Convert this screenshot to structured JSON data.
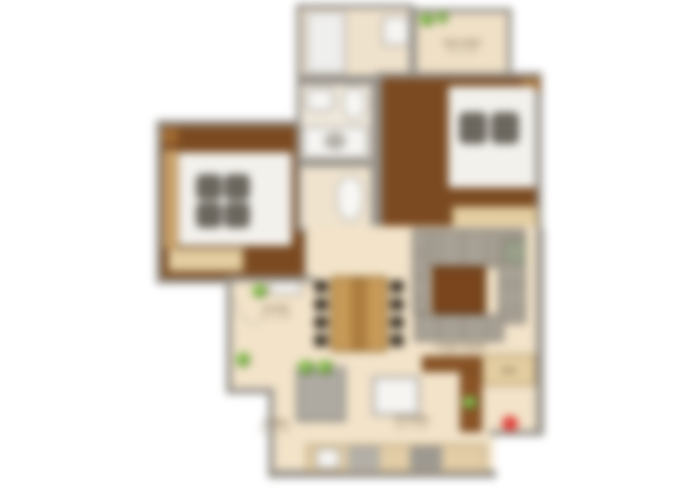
{
  "image": {
    "kind": "blurred residential floor plan, 2 bedroom apartment, top-down render",
    "background_color": "#ffffff"
  },
  "palette": {
    "wall_gray": "#96918a",
    "bedroom_wood_floor": "#7b4a21",
    "living_tile_floor": "#f2e3c9",
    "bath_floor": "#f0e9dc",
    "wardrobe_beige": "#e9d4a8",
    "dining_wood": "#c79a58",
    "coffee_table_wood": "#7a451d",
    "sofa_gray": "#a7a094",
    "plant_green": "#4e7a2a",
    "watermark_red": "#e0433c"
  },
  "labels": {
    "balcony": {
      "name": "BALCONY",
      "dims": "7'6\" X 4'0\""
    },
    "foyer": {
      "name": "FOYER",
      "dims": "5'6\" X 4'6\""
    },
    "living": {
      "name": "LIVING ROOM",
      "dims": "13'6\" X 10'0\""
    },
    "kitchen": {
      "name": "KITCHEN",
      "dims": "10'0\" X 8'0\""
    },
    "passage": {
      "name": "STORE",
      "dims": "5'0\" X 4'0\""
    },
    "fridge": {
      "name": "REF."
    }
  },
  "rooms": [
    "utility-shower-room",
    "balcony",
    "bedroom-right",
    "bedroom-left",
    "bathroom-top",
    "toilet-bottom",
    "foyer",
    "living-dining",
    "kitchen"
  ],
  "furniture": {
    "beds": 2,
    "wardrobes": 2,
    "dining_chairs": 8,
    "dining_table": 1,
    "l_shaped_sofa": 1,
    "coffee_table": 1,
    "tv_console": 1,
    "kitchen_island": 1,
    "sink": 1,
    "hob": 1,
    "toilets": 2,
    "washbasins": 2,
    "shower": 1,
    "plants": 7
  },
  "watermark": {
    "shape": "red dot",
    "color": "#e0433c"
  }
}
